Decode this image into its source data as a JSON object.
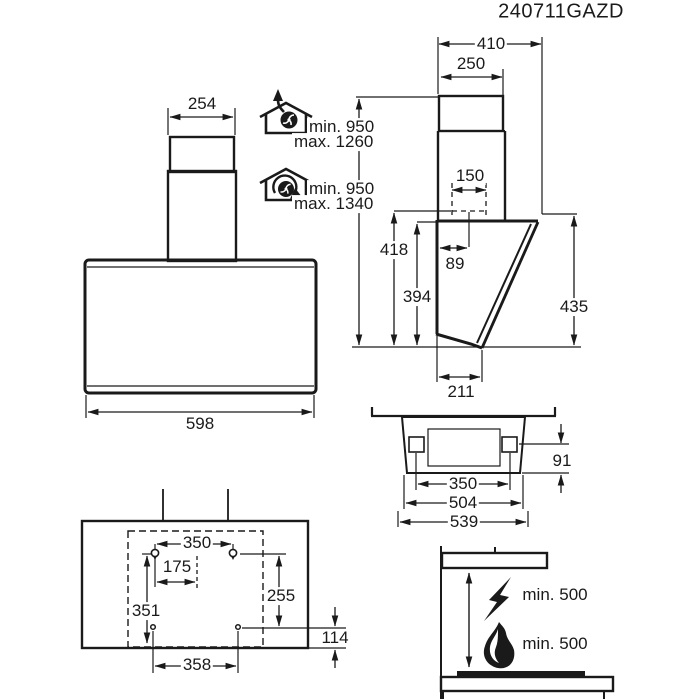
{
  "title": "240711GAZD",
  "side_view": {
    "width_total": "410",
    "chimney_depth": "250",
    "duct_diameter": "150",
    "duct_center_offset": "89",
    "height_rear": "418",
    "height_panel": "394",
    "height_front": "435",
    "depth_bottom": "211"
  },
  "front_view": {
    "chimney_width": "254",
    "body_width": "598"
  },
  "installation_height": {
    "extraction": {
      "min": "min. 950",
      "max": "max. 1260"
    },
    "recirculation": {
      "min": "min. 950",
      "max": "max. 1340"
    }
  },
  "bottom_view": {
    "bracket_spacing": "350",
    "inner_width": "504",
    "outer_width": "539",
    "bracket_depth": "91"
  },
  "mounting_template": {
    "upper_holes_spacing": "350",
    "center_offset": "175",
    "height_left": "351",
    "height_right": "255",
    "lower_edge_offset": "114",
    "lower_holes_spacing": "358"
  },
  "clearances": {
    "electric_hob": "min. 500",
    "gas_hob": "min. 500"
  },
  "icons": {
    "extraction": "house-fan-exhaust-icon",
    "recirculation": "house-fan-recirculation-icon",
    "electric": "lightning-icon",
    "gas": "flame-icon"
  },
  "colors": {
    "line": "#1a1a1a",
    "background": "#ffffff"
  }
}
